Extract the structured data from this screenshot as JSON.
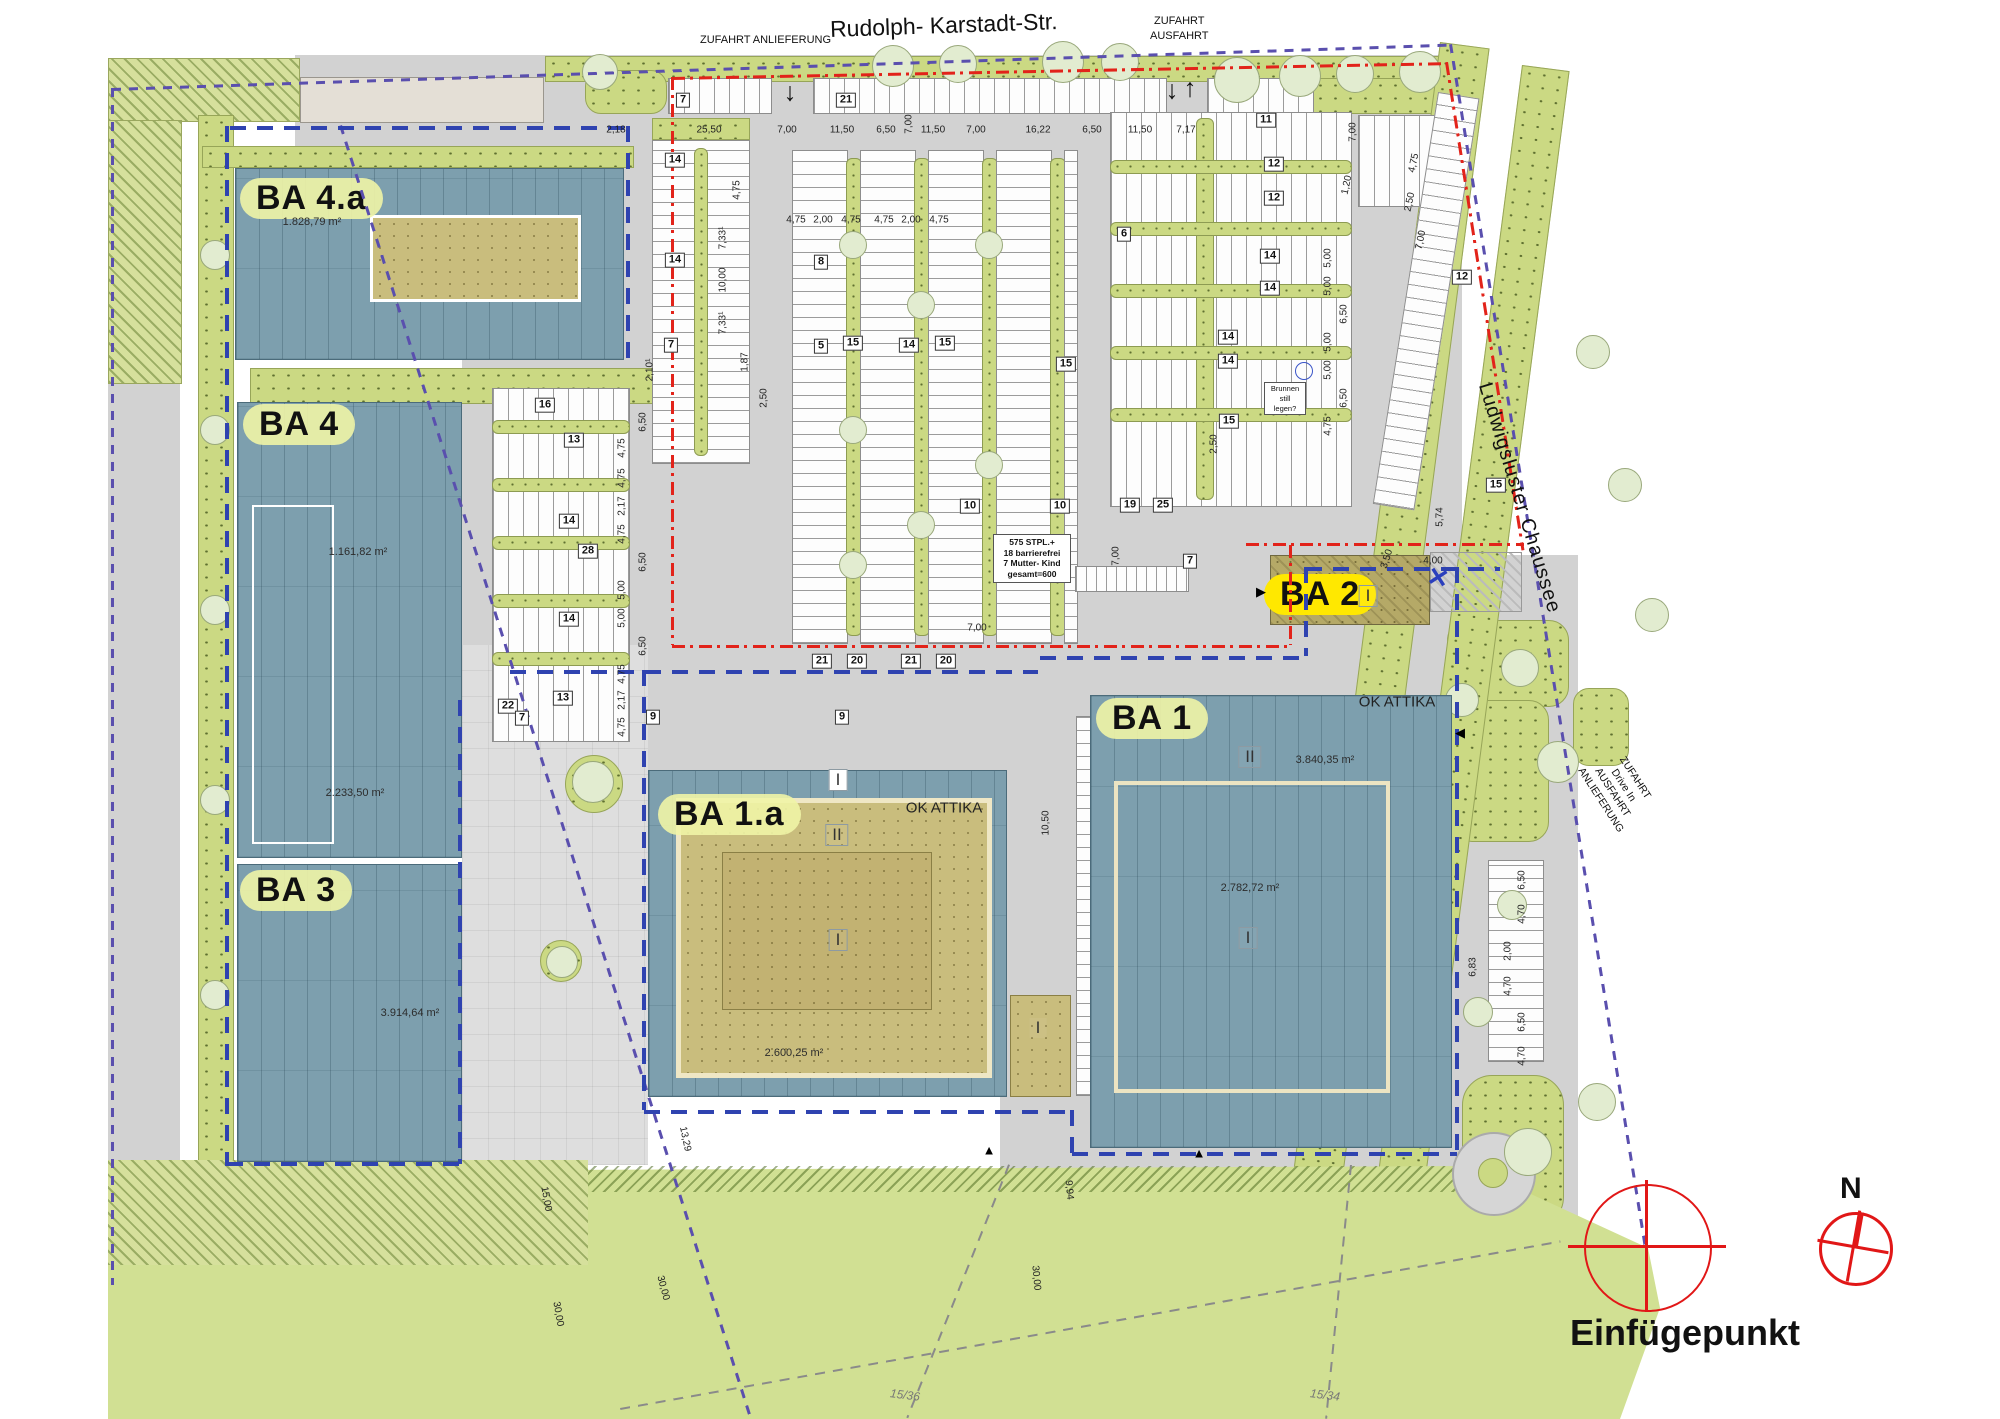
{
  "streets": {
    "top": "Rudolph- Karstadt-Str.",
    "right": "Ludwigsluster Chaussee"
  },
  "entrances": {
    "top_left": "ZUFAHRT ANLIEFERUNG",
    "top_right": [
      "ZUFAHRT",
      "AUSFAHRT"
    ],
    "right_side": [
      "ZUFAHRT",
      "Drive In",
      "AUSFAHRT",
      "ANLIEFERUNG"
    ]
  },
  "buildings": {
    "ba4a": {
      "label": "BA 4.a",
      "area": "1.828,79 m²"
    },
    "ba4": {
      "label": "BA 4",
      "area_upper": "1.161,82 m²",
      "area_lower": "2.233,50 m²"
    },
    "ba3": {
      "label": "BA 3",
      "area": "3.914,64 m²"
    },
    "ba2": {
      "label": "BA 2",
      "storey": "I"
    },
    "ba1": {
      "label": "BA 1",
      "attika": "OK ATTIKA",
      "storey_upper": "II",
      "storey_lower": "I",
      "area_upper": "3.840,35 m²",
      "area_lower": "2.782,72 m²"
    },
    "ba1a": {
      "label": "BA 1.a",
      "attika": "OK ATTIKA",
      "storey_upper": "II",
      "storey_lower": "I",
      "area": "2.600,25 m²",
      "roof_mark": "I",
      "side_mark": "I"
    }
  },
  "notes": {
    "parking_summary": [
      "575 STPL.+",
      "18 barrierefrei",
      "7 Mutter- Kind",
      "gesamt=600"
    ],
    "well": [
      "Brunnen",
      "still",
      "legen?"
    ]
  },
  "compass": {
    "label": "N"
  },
  "insertion": {
    "label": "Einfügepunkt"
  },
  "parcels": [
    "15/36",
    "15/34"
  ],
  "icons": {
    "down_arrow": "↓",
    "up_arrow": "↑",
    "x_mark": "✕",
    "tri_up": "▲",
    "tri_left": "◀",
    "tri_right": "▶"
  },
  "parking_badges": [
    {
      "v": "7",
      "x": 683,
      "y": 100
    },
    {
      "v": "21",
      "x": 846,
      "y": 100
    },
    {
      "v": "11",
      "x": 1266,
      "y": 120
    },
    {
      "v": "12",
      "x": 1274,
      "y": 164
    },
    {
      "v": "12",
      "x": 1274,
      "y": 198
    },
    {
      "v": "6",
      "x": 1124,
      "y": 234
    },
    {
      "v": "14",
      "x": 675,
      "y": 160
    },
    {
      "v": "14",
      "x": 675,
      "y": 260
    },
    {
      "v": "8",
      "x": 821,
      "y": 262
    },
    {
      "v": "14",
      "x": 1270,
      "y": 256
    },
    {
      "v": "14",
      "x": 1270,
      "y": 288
    },
    {
      "v": "7",
      "x": 671,
      "y": 345
    },
    {
      "v": "5",
      "x": 821,
      "y": 346
    },
    {
      "v": "15",
      "x": 853,
      "y": 343
    },
    {
      "v": "14",
      "x": 909,
      "y": 345
    },
    {
      "v": "15",
      "x": 945,
      "y": 343
    },
    {
      "v": "14",
      "x": 1228,
      "y": 337
    },
    {
      "v": "14",
      "x": 1228,
      "y": 361
    },
    {
      "v": "15",
      "x": 1066,
      "y": 364
    },
    {
      "v": "16",
      "x": 545,
      "y": 405
    },
    {
      "v": "13",
      "x": 574,
      "y": 440
    },
    {
      "v": "15",
      "x": 1229,
      "y": 421
    },
    {
      "v": "12",
      "x": 1462,
      "y": 277
    },
    {
      "v": "15",
      "x": 1496,
      "y": 485
    },
    {
      "v": "14",
      "x": 569,
      "y": 521
    },
    {
      "v": "28",
      "x": 588,
      "y": 551
    },
    {
      "v": "14",
      "x": 569,
      "y": 619
    },
    {
      "v": "13",
      "x": 563,
      "y": 698
    },
    {
      "v": "22",
      "x": 508,
      "y": 706
    },
    {
      "v": "7",
      "x": 522,
      "y": 718
    },
    {
      "v": "10",
      "x": 970,
      "y": 506
    },
    {
      "v": "10",
      "x": 1060,
      "y": 506
    },
    {
      "v": "19",
      "x": 1130,
      "y": 505
    },
    {
      "v": "25",
      "x": 1163,
      "y": 505
    },
    {
      "v": "7",
      "x": 1190,
      "y": 561
    },
    {
      "v": "21",
      "x": 822,
      "y": 661
    },
    {
      "v": "20",
      "x": 857,
      "y": 661
    },
    {
      "v": "21",
      "x": 911,
      "y": 661
    },
    {
      "v": "20",
      "x": 946,
      "y": 661
    },
    {
      "v": "9",
      "x": 653,
      "y": 717
    },
    {
      "v": "9",
      "x": 842,
      "y": 717
    }
  ],
  "dimensions": [
    {
      "v": "2,18",
      "x": 616,
      "y": 130
    },
    {
      "v": "25,50",
      "x": 709,
      "y": 130
    },
    {
      "v": "7,00",
      "x": 787,
      "y": 130
    },
    {
      "v": "11,50",
      "x": 842,
      "y": 130
    },
    {
      "v": "6,50",
      "x": 886,
      "y": 130
    },
    {
      "v": "7,00",
      "x": 909,
      "y": 124,
      "r": -90
    },
    {
      "v": "11,50",
      "x": 933,
      "y": 130
    },
    {
      "v": "7,00",
      "x": 976,
      "y": 130
    },
    {
      "v": "16,22",
      "x": 1038,
      "y": 130
    },
    {
      "v": "6,50",
      "x": 1092,
      "y": 130
    },
    {
      "v": "11,50",
      "x": 1140,
      "y": 130
    },
    {
      "v": "7,17",
      "x": 1186,
      "y": 130
    },
    {
      "v": "7,00",
      "x": 1353,
      "y": 132,
      "r": -90
    },
    {
      "v": "4,75",
      "x": 796,
      "y": 220
    },
    {
      "v": "2,00",
      "x": 823,
      "y": 220
    },
    {
      "v": "4,75",
      "x": 851,
      "y": 220
    },
    {
      "v": "4,75",
      "x": 884,
      "y": 220
    },
    {
      "v": "2,00",
      "x": 911,
      "y": 220
    },
    {
      "v": "4,75",
      "x": 939,
      "y": 220
    },
    {
      "v": "4,75",
      "x": 737,
      "y": 190,
      "r": -90
    },
    {
      "v": "7,33¹",
      "x": 723,
      "y": 238,
      "r": -90
    },
    {
      "v": "10,00",
      "x": 723,
      "y": 280,
      "r": -90
    },
    {
      "v": "7,33¹",
      "x": 723,
      "y": 323,
      "r": -90
    },
    {
      "v": "1,87",
      "x": 745,
      "y": 362,
      "r": -90
    },
    {
      "v": "2,10¹",
      "x": 650,
      "y": 370,
      "r": -90
    },
    {
      "v": "2,50",
      "x": 764,
      "y": 398,
      "r": -90
    },
    {
      "v": "6,50",
      "x": 643,
      "y": 422,
      "r": -90
    },
    {
      "v": "4,75",
      "x": 622,
      "y": 448,
      "r": -90
    },
    {
      "v": "4,75",
      "x": 622,
      "y": 478,
      "r": -90
    },
    {
      "v": "2,17",
      "x": 622,
      "y": 506,
      "r": -90
    },
    {
      "v": "4,75",
      "x": 622,
      "y": 534,
      "r": -90
    },
    {
      "v": "6,50",
      "x": 643,
      "y": 562,
      "r": -90
    },
    {
      "v": "5,00",
      "x": 622,
      "y": 590,
      "r": -90
    },
    {
      "v": "5,00",
      "x": 622,
      "y": 618,
      "r": -90
    },
    {
      "v": "6,50",
      "x": 643,
      "y": 646,
      "r": -90
    },
    {
      "v": "4,75",
      "x": 622,
      "y": 674,
      "r": -90
    },
    {
      "v": "2,17",
      "x": 622,
      "y": 700,
      "r": -90
    },
    {
      "v": "4,75",
      "x": 622,
      "y": 727,
      "r": -90
    },
    {
      "v": "5,00",
      "x": 1328,
      "y": 258,
      "r": -90
    },
    {
      "v": "5,00",
      "x": 1328,
      "y": 286,
      "r": -90
    },
    {
      "v": "6,50",
      "x": 1344,
      "y": 314,
      "r": -90
    },
    {
      "v": "5,00",
      "x": 1328,
      "y": 342,
      "r": -90
    },
    {
      "v": "5,00",
      "x": 1328,
      "y": 370,
      "r": -90
    },
    {
      "v": "6,50",
      "x": 1344,
      "y": 398,
      "r": -90
    },
    {
      "v": "4,75",
      "x": 1328,
      "y": 426,
      "r": -90
    },
    {
      "v": "2,50",
      "x": 1214,
      "y": 444,
      "r": -90
    },
    {
      "v": "1,20",
      "x": 1347,
      "y": 185,
      "r": -78
    },
    {
      "v": "4,75",
      "x": 1414,
      "y": 163,
      "r": -78
    },
    {
      "v": "2,50",
      "x": 1410,
      "y": 202,
      "r": -78
    },
    {
      "v": "7,00",
      "x": 1421,
      "y": 240,
      "r": -78
    },
    {
      "v": "5,74",
      "x": 1440,
      "y": 517,
      "r": -90
    },
    {
      "v": "7,00",
      "x": 1116,
      "y": 556,
      "r": -90
    },
    {
      "v": "7,00",
      "x": 977,
      "y": 628
    },
    {
      "v": "10,50",
      "x": 1046,
      "y": 823,
      "r": -90
    },
    {
      "v": "3,50",
      "x": 1387,
      "y": 559,
      "r": -72
    },
    {
      "v": "4,00",
      "x": 1433,
      "y": 561
    },
    {
      "v": "13,29",
      "x": 685,
      "y": 1139,
      "r": 78
    },
    {
      "v": "15,00",
      "x": 546,
      "y": 1199,
      "r": 80
    },
    {
      "v": "30,00",
      "x": 558,
      "y": 1314,
      "r": 80
    },
    {
      "v": "30,00",
      "x": 663,
      "y": 1288,
      "r": 75
    },
    {
      "v": "30,00",
      "x": 1036,
      "y": 1278,
      "r": 85
    },
    {
      "v": "9,94",
      "x": 1069,
      "y": 1190,
      "r": 85
    },
    {
      "v": "6,83",
      "x": 1473,
      "y": 967,
      "r": -90
    },
    {
      "v": "6,50",
      "x": 1522,
      "y": 880,
      "r": -90
    },
    {
      "v": "4,70",
      "x": 1522,
      "y": 914,
      "r": -90
    },
    {
      "v": "2,00",
      "x": 1508,
      "y": 951,
      "r": -90
    },
    {
      "v": "4,70",
      "x": 1508,
      "y": 986,
      "r": -90
    },
    {
      "v": "6,50",
      "x": 1522,
      "y": 1022,
      "r": -90
    },
    {
      "v": "4,70",
      "x": 1522,
      "y": 1056,
      "r": -90
    }
  ],
  "decor": {
    "trees": [
      {
        "x": 600,
        "y": 72,
        "s": 34
      },
      {
        "x": 893,
        "y": 66,
        "s": 40
      },
      {
        "x": 958,
        "y": 64,
        "s": 36
      },
      {
        "x": 1063,
        "y": 62,
        "s": 40
      },
      {
        "x": 1120,
        "y": 62,
        "s": 36
      },
      {
        "x": 1237,
        "y": 80,
        "s": 44
      },
      {
        "x": 1300,
        "y": 76,
        "s": 40
      },
      {
        "x": 1355,
        "y": 74,
        "s": 36
      },
      {
        "x": 1420,
        "y": 72,
        "s": 40
      },
      {
        "x": 215,
        "y": 255,
        "s": 28
      },
      {
        "x": 215,
        "y": 430,
        "s": 28
      },
      {
        "x": 215,
        "y": 610,
        "s": 28
      },
      {
        "x": 215,
        "y": 800,
        "s": 28
      },
      {
        "x": 215,
        "y": 995,
        "s": 28
      },
      {
        "x": 853,
        "y": 245,
        "s": 26
      },
      {
        "x": 853,
        "y": 430,
        "s": 26
      },
      {
        "x": 853,
        "y": 565,
        "s": 26
      },
      {
        "x": 921,
        "y": 305,
        "s": 26
      },
      {
        "x": 921,
        "y": 525,
        "s": 26
      },
      {
        "x": 989,
        "y": 245,
        "s": 26
      },
      {
        "x": 989,
        "y": 465,
        "s": 26
      },
      {
        "x": 593,
        "y": 782,
        "s": 40
      },
      {
        "x": 562,
        "y": 962,
        "s": 30
      },
      {
        "x": 1520,
        "y": 668,
        "s": 36
      },
      {
        "x": 1558,
        "y": 762,
        "s": 40
      },
      {
        "x": 1593,
        "y": 352,
        "s": 32
      },
      {
        "x": 1625,
        "y": 485,
        "s": 32
      },
      {
        "x": 1652,
        "y": 615,
        "s": 32
      },
      {
        "x": 1512,
        "y": 905,
        "s": 28
      },
      {
        "x": 1478,
        "y": 1012,
        "s": 28
      },
      {
        "x": 1528,
        "y": 1152,
        "s": 46
      },
      {
        "x": 1597,
        "y": 1102,
        "s": 36
      },
      {
        "x": 1462,
        "y": 700,
        "s": 32
      }
    ]
  }
}
